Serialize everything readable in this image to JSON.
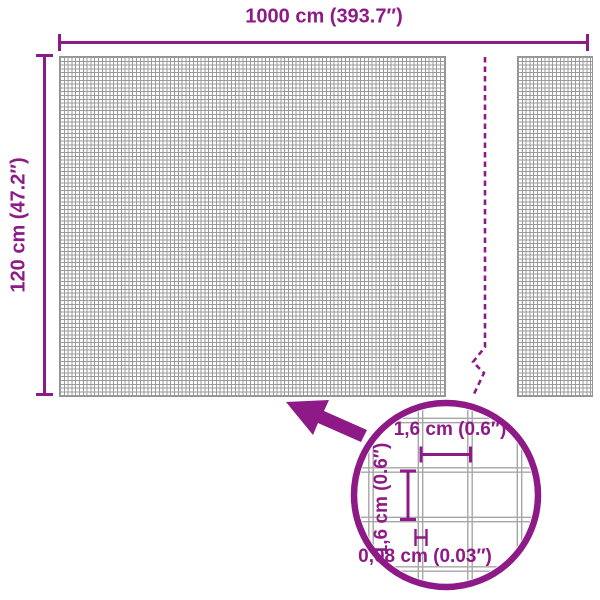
{
  "colors": {
    "brand": "#8E1A87",
    "mesh_grid": "#9A9A9A",
    "detail_grid": "#A6A6A6"
  },
  "overall": {
    "width_label": "1000 cm (393.7″)",
    "height_label": "120 cm (47.2″)"
  },
  "detail": {
    "mesh_width_label": "1,6 cm (0.6″)",
    "mesh_height_label": "1,6 cm (0.6″)",
    "wire_thickness_label": "0,08 cm (0.03″)"
  }
}
